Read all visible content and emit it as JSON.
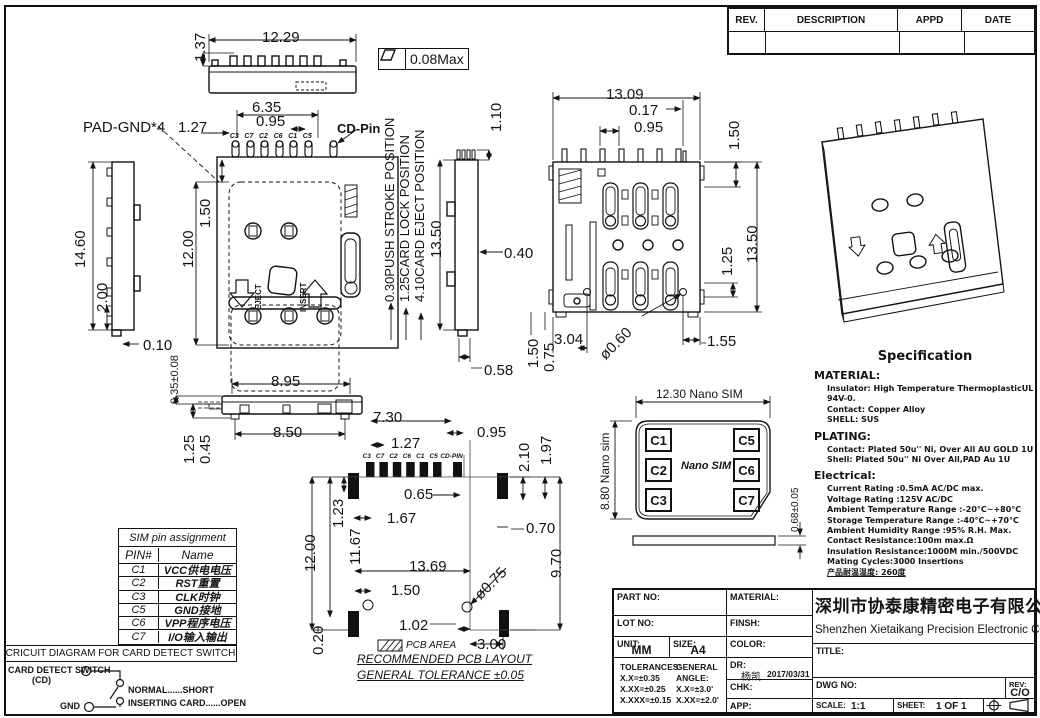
{
  "revision_table": {
    "col_rev": "REV.",
    "col_desc": "DESCRIPTION",
    "col_appd": "APPD",
    "col_date": "DATE"
  },
  "views": {
    "top": {
      "w": "12.29",
      "h": "1.37",
      "flatness": "0.08Max"
    },
    "front": {
      "pad_gnd": "PAD-GND*4",
      "d127": "1.27",
      "d635": "6.35",
      "d095": "0.95",
      "cd_pin": "CD-Pin",
      "pins": [
        "C3",
        "C7",
        "C2",
        "C6",
        "C1",
        "C5"
      ],
      "d150": "1.50",
      "d1200": "12.00",
      "eject": "EJECT",
      "insert": "INSERT",
      "pos_push": "0.30PUSH STROKE POSITION",
      "pos_lock": "1.25CARD LOCK POSITION",
      "pos_eject": "4.10CARD EJECT POSITION",
      "d1350": "13.50"
    },
    "left_side": {
      "d1460": "14.60",
      "d200": "2.00",
      "d010": "0.10"
    },
    "card_tol": "0.35±0.08",
    "right_side": {
      "d110": "1.10",
      "d040": "0.40",
      "d058": "0.58"
    },
    "bottom": {
      "w": "13.09",
      "d017": "0.17",
      "d095": "0.95",
      "d150": "1.50",
      "h": "13.50",
      "d125": "1.25",
      "d155": "1.55",
      "d304": "3.04",
      "hole": "ø0.60",
      "d150b": "1.50",
      "d075": "0.75"
    },
    "side_bottom": {
      "d895": "8.95",
      "d850": "8.50",
      "d125": "1.25",
      "d045": "0.45"
    },
    "pcb": {
      "d730": "7.30",
      "d095": "0.95",
      "d127": "1.27",
      "pins": [
        "C3",
        "C7",
        "C2",
        "C6",
        "C1",
        "C5",
        "CD-PIN"
      ],
      "d065": "0.65",
      "d167": "1.67",
      "d123": "1.23",
      "d1167": "11.67",
      "d1200": "12.00",
      "d1369": "13.69",
      "d150": "1.50",
      "d020": "0.20",
      "d102": "1.02",
      "d300": "3.00",
      "hole": "ø0.75",
      "d210": "2.10",
      "d197": "1.97",
      "d070": "0.70",
      "d970": "9.70",
      "area_label": "PCB AREA",
      "title": "RECOMMENDED PCB LAYOUT",
      "tolerance": "GENERAL TOLERANCE ±0.05"
    },
    "nano_sim": {
      "w": "12.30 Nano SIM",
      "h": "8.80 Nano sim",
      "t": "0.68±0.05",
      "center": "Nano SIM",
      "pads_left": [
        "C1",
        "C2",
        "C3"
      ],
      "pads_right": [
        "C5",
        "C6",
        "C7"
      ]
    }
  },
  "sim_table": {
    "title": "SIM pin assignment",
    "col_pin": "PIN#",
    "col_name": "Name",
    "rows": [
      {
        "pin": "C1",
        "name": "VCC供电电压"
      },
      {
        "pin": "C2",
        "name": "RST重置"
      },
      {
        "pin": "C3",
        "name": "CLK时钟"
      },
      {
        "pin": "C5",
        "name": "GND接地"
      },
      {
        "pin": "C6",
        "name": "VPP程序电压"
      },
      {
        "pin": "C7",
        "name": "I/O输入输出"
      }
    ]
  },
  "circuit": {
    "title": "CRICUIT DIAGRAM FOR CARD DETECT SWITCH",
    "switch_label": "CARD DETECT SWITCH",
    "cd": "(CD)",
    "gnd": "GND",
    "normal": "NORMAL......SHORT",
    "inserting": "INSERTING CARD......OPEN"
  },
  "spec": {
    "title": "Specification",
    "material_h": "MATERIAL:",
    "material": [
      "Insulator: High Temperature ThermoplasticUL 94V-0.",
      "Contact: Copper Alloy",
      "SHELL: SUS"
    ],
    "plating_h": "PLATING:",
    "plating": [
      "Contact: Plated 50u'' Ni, Over All AU GOLD 1U",
      "Shell: Plated 50u'' Ni Over All,PAD Au 1U"
    ],
    "electrical_h": "Electrical:",
    "electrical": [
      "Current Rating :0.5mA AC/DC max.",
      "Voltage Rating :125V AC/DC",
      "Ambient Temperature Range :-20°C~+80°C",
      "Storage Temperature Range :-40°C~+70°C",
      "Ambient Humidity Range :95% R.H. Max.",
      "Contact Resistance:100m max.Ω",
      "Insulation Resistance:1000M min./500VDC",
      "Mating Cycles:3000 Insertions",
      "产品耐温温度: 260度"
    ]
  },
  "title_block": {
    "part_no": "PART NO:",
    "lot_no": "LOT NO:",
    "unit_label": "UNIT:",
    "unit": "MM",
    "size_label": "SIZE:",
    "size": "A4",
    "tol_h": "TOLERANCES:",
    "tol": [
      "X.X=±0.35",
      "X.XX=±0.25",
      "X.XXX=±0.15"
    ],
    "angle_h": "GENERAL ANGLE:",
    "angle": [
      "X.X=±3.0'",
      "X.XX=±2.0'"
    ],
    "material": "MATERIAL:",
    "finish": "FINSH:",
    "color": "COLOR:",
    "dr": "DR:",
    "dr_name": "杨凯",
    "dr_date": "2017/03/31",
    "chk": "CHK:",
    "app": "APP:",
    "company_cn": "深圳市协泰康精密电子有限公司",
    "company_en": "Shenzhen Xietaikang Precision Electronic Co.,Ltd",
    "title_label": "TITLE:",
    "dwg_no": "DWG NO:",
    "rev_label": "REV:",
    "rev": "C/O",
    "scale_label": "SCALE:",
    "scale": "1:1",
    "sheet_label": "SHEET:",
    "sheet": "1 OF 1"
  }
}
